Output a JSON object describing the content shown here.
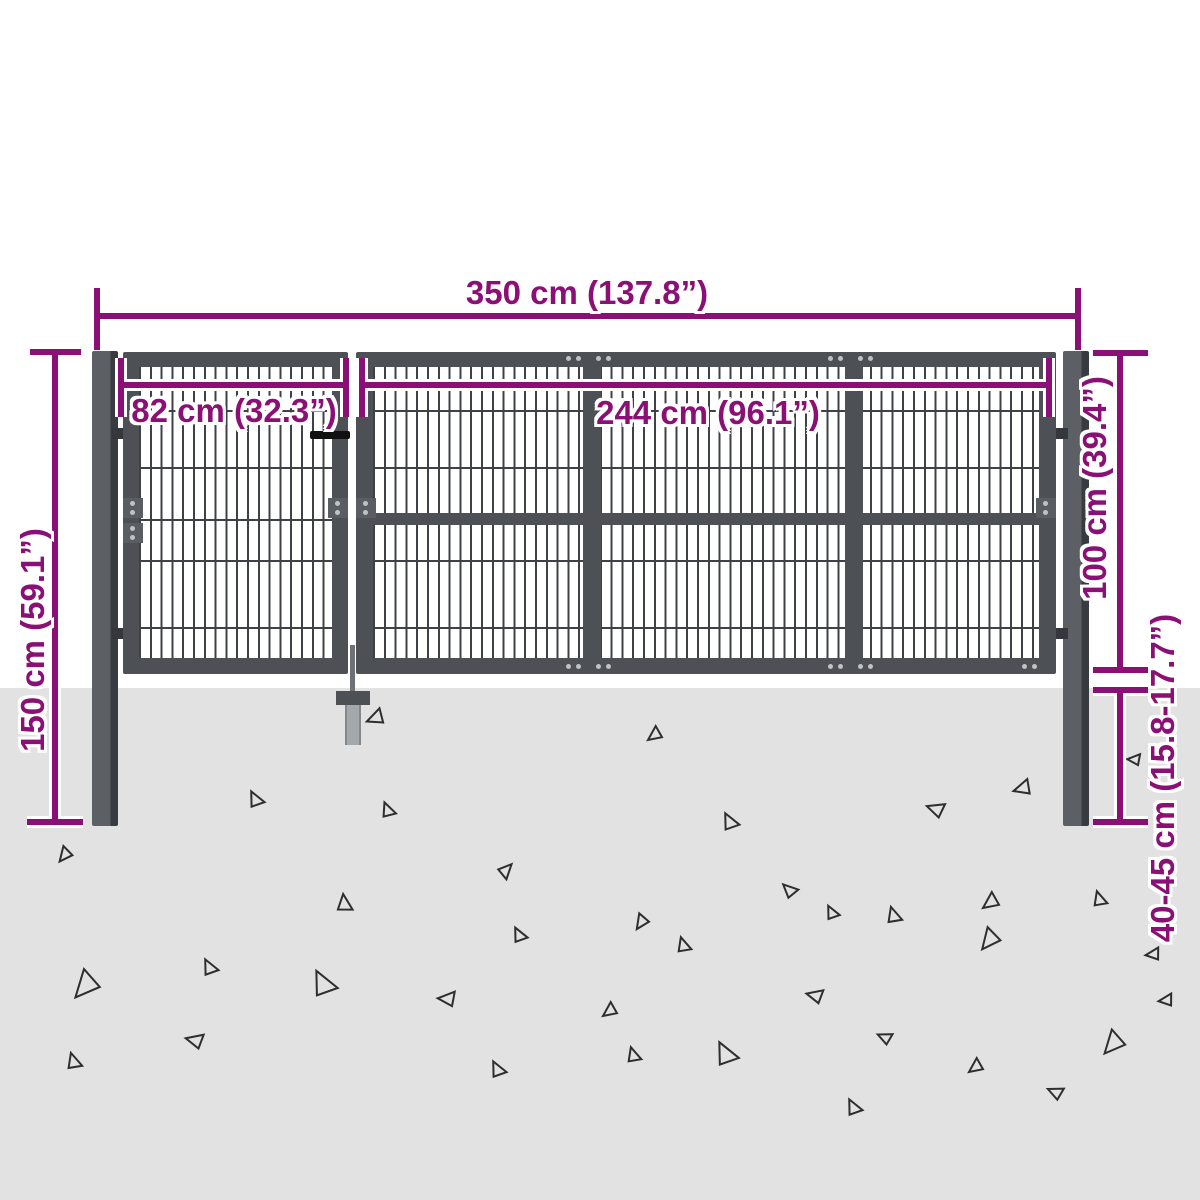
{
  "labels": {
    "total_width": "350 cm (137.8”)",
    "left_gate_width": "82 cm (32.3”)",
    "right_gate_width": "244 cm (96.1”)",
    "post_height": "150 cm (59.1”)",
    "gate_height": "100 cm (39.4”)",
    "underground_depth": "40-45 cm (15.8-17.7”)"
  },
  "colors": {
    "dimension": "#8a1075",
    "halo": "#ffffff",
    "frame": "#4d5156",
    "post": "#5c6064",
    "post_edge": "#383c40",
    "mesh": "#3e4246",
    "ground": "#e2e2e2",
    "bolt": "#bfc3c6",
    "handle": "#111111",
    "anchor_stem": "#a4a8ab"
  },
  "ground_triangles": [
    {
      "x": 371,
      "y": 706,
      "s": 16,
      "r": 15
    },
    {
      "x": 648,
      "y": 726,
      "s": 14,
      "r": 0
    },
    {
      "x": 56,
      "y": 848,
      "s": 14,
      "r": -15
    },
    {
      "x": 266,
      "y": 794,
      "s": 15,
      "r": 100
    },
    {
      "x": 398,
      "y": 806,
      "s": 14,
      "r": 105
    },
    {
      "x": 357,
      "y": 902,
      "s": 16,
      "r": 120
    },
    {
      "x": 514,
      "y": 878,
      "s": 14,
      "r": 170
    },
    {
      "x": 741,
      "y": 816,
      "s": 16,
      "r": 100
    },
    {
      "x": 940,
      "y": 797,
      "s": 16,
      "r": 55
    },
    {
      "x": 1019,
      "y": 776,
      "s": 16,
      "r": 20
    },
    {
      "x": 797,
      "y": 882,
      "s": 14,
      "r": 80
    },
    {
      "x": 983,
      "y": 892,
      "s": 16,
      "r": 0
    },
    {
      "x": 905,
      "y": 912,
      "s": 15,
      "r": 110
    },
    {
      "x": 632,
      "y": 916,
      "s": 14,
      "r": -20
    },
    {
      "x": 1110,
      "y": 896,
      "s": 14,
      "r": 110
    },
    {
      "x": 70,
      "y": 972,
      "s": 26,
      "r": -12
    },
    {
      "x": 220,
      "y": 962,
      "s": 15,
      "r": 100
    },
    {
      "x": 198,
      "y": 1028,
      "s": 16,
      "r": 50
    },
    {
      "x": 85,
      "y": 1058,
      "s": 15,
      "r": 110
    },
    {
      "x": 340,
      "y": 975,
      "s": 24,
      "r": 100
    },
    {
      "x": 448,
      "y": 986,
      "s": 16,
      "r": 40
    },
    {
      "x": 529,
      "y": 930,
      "s": 14,
      "r": 100
    },
    {
      "x": 508,
      "y": 1064,
      "s": 15,
      "r": 100
    },
    {
      "x": 841,
      "y": 908,
      "s": 13,
      "r": 100
    },
    {
      "x": 694,
      "y": 942,
      "s": 14,
      "r": 110
    },
    {
      "x": 818,
      "y": 984,
      "s": 15,
      "r": 50
    },
    {
      "x": 603,
      "y": 1002,
      "s": 14,
      "r": 0
    },
    {
      "x": 644,
      "y": 1052,
      "s": 14,
      "r": 110
    },
    {
      "x": 741,
      "y": 1046,
      "s": 22,
      "r": 100
    },
    {
      "x": 889,
      "y": 1028,
      "s": 13,
      "r": 60
    },
    {
      "x": 864,
      "y": 1102,
      "s": 15,
      "r": 100
    },
    {
      "x": 969,
      "y": 1058,
      "s": 14,
      "r": 0
    },
    {
      "x": 977,
      "y": 930,
      "s": 20,
      "r": -15
    },
    {
      "x": 1060,
      "y": 1082,
      "s": 14,
      "r": 60
    },
    {
      "x": 1100,
      "y": 1032,
      "s": 22,
      "r": -12
    },
    {
      "x": 1165,
      "y": 990,
      "s": 13,
      "r": 30
    },
    {
      "x": 1152,
      "y": 944,
      "s": 13,
      "r": 30
    },
    {
      "x": 1135,
      "y": 750,
      "s": 12,
      "r": 40
    }
  ]
}
